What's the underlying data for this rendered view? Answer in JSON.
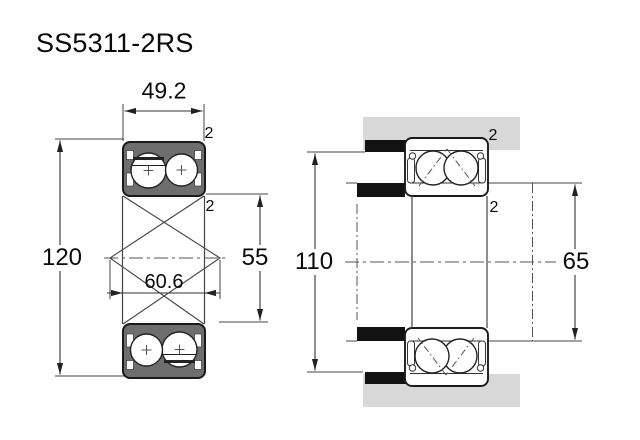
{
  "title": "SS5311-2RS",
  "colors": {
    "ring_fill": "#6e6e6e",
    "housing_fill": "#d8d8d8",
    "shoulder_fill": "#121212",
    "line": "#333333"
  },
  "section_view": {
    "name": "bearing cross-section view",
    "dims": {
      "width": "49.2",
      "outer_diameter": "120",
      "bore_diameter": "55",
      "pitch_diameter": "60.6",
      "chamfer_outer": "2",
      "chamfer_inner": "2"
    }
  },
  "mounted_view": {
    "name": "mounted bearing view",
    "dims": {
      "housing_abutment_diameter": "110",
      "shaft_abutment_diameter": "65",
      "chamfer_outer": "2",
      "chamfer_inner": "2"
    }
  }
}
